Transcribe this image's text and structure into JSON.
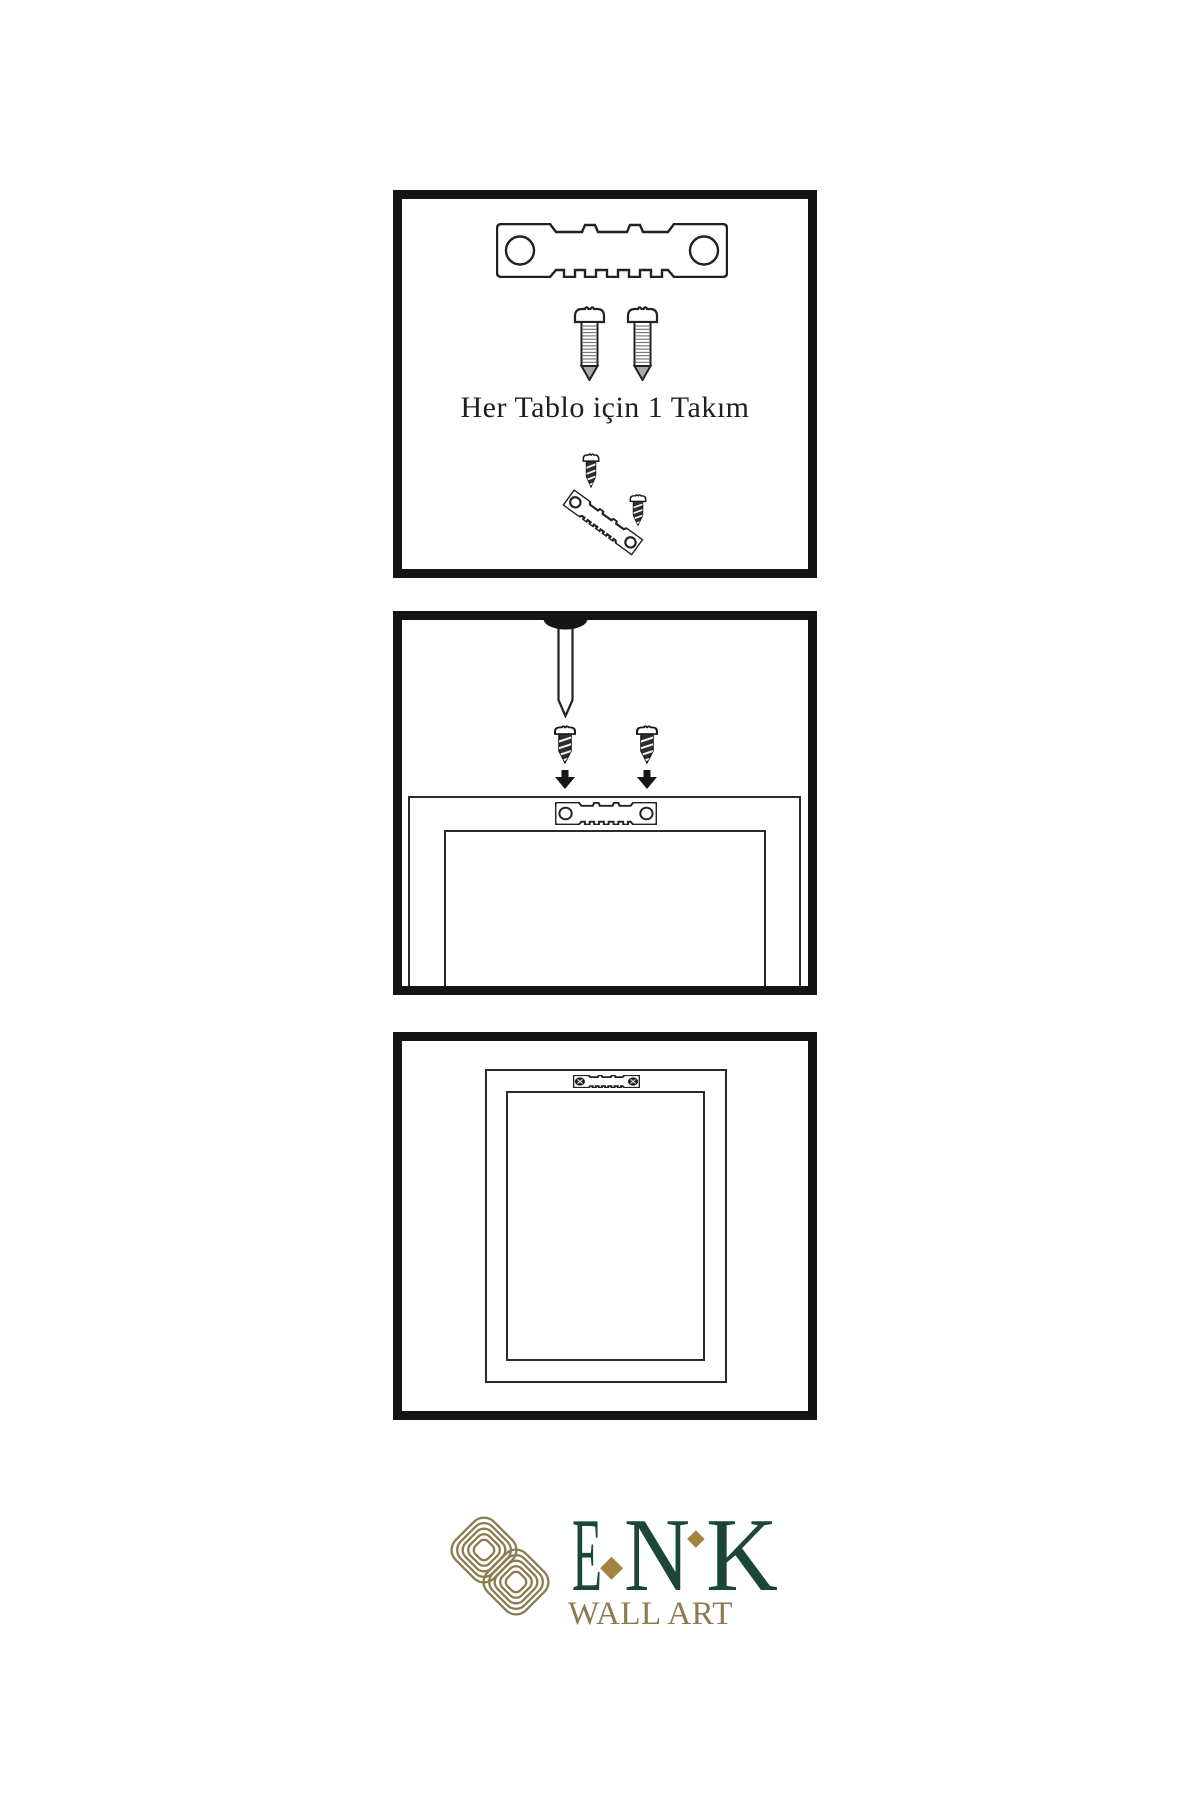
{
  "instructions": {
    "step1": {
      "caption": "Her Tablo için 1 Takım",
      "parts": [
        "sawtooth-hanger",
        "screw",
        "screw",
        "screw",
        "angled-sawtooth-hanger",
        "screw"
      ]
    },
    "step2": {
      "parts": [
        "wall-nail",
        "screw",
        "screw",
        "down-arrow",
        "down-arrow",
        "sawtooth-hanger",
        "frame-back"
      ]
    },
    "step3": {
      "parts": [
        "mounted-sawtooth-hanger",
        "hung-frame"
      ]
    }
  },
  "brand": {
    "letters": [
      "E",
      "N",
      "K"
    ],
    "subtitle": "WALL ART",
    "diamond_glyph": "◆",
    "green": "#1b463a",
    "gold": "#8d7b4f",
    "diamond_gold": "#a0843f"
  },
  "colors": {
    "line": "#1a1a1a",
    "panel_border": "#141414",
    "background": "#ffffff"
  }
}
